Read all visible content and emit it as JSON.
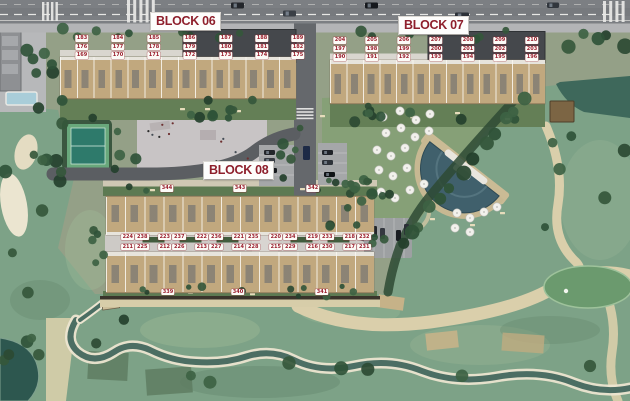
{
  "blocks": {
    "block06": {
      "title": "BLOCK 06",
      "rows": [
        [
          "183",
          "184",
          "185",
          "186",
          "187",
          "188",
          "189"
        ],
        [
          "176",
          "177",
          "178",
          "179",
          "180",
          "181",
          "182"
        ],
        [
          "169",
          "170",
          "171",
          "172",
          "173",
          "174",
          "175"
        ]
      ]
    },
    "block07": {
      "title": "BLOCK 07",
      "rows": [
        [
          "204",
          "205",
          "206",
          "207",
          "208",
          "209",
          "210"
        ],
        [
          "197",
          "198",
          "199",
          "200",
          "201",
          "202",
          "203"
        ],
        [
          "190",
          "191",
          "192",
          "193",
          "194",
          "195",
          "196"
        ]
      ]
    },
    "block08": {
      "title": "BLOCK 08",
      "pair_rows": [
        [
          [
            "224",
            "238"
          ],
          [
            "223",
            "237"
          ],
          [
            "222",
            "236"
          ],
          [
            "221",
            "235"
          ],
          [
            "220",
            "234"
          ],
          [
            "219",
            "233"
          ],
          [
            "218",
            "232"
          ]
        ],
        [
          [
            "211",
            "225"
          ],
          [
            "212",
            "226"
          ],
          [
            "213",
            "227"
          ],
          [
            "214",
            "228"
          ],
          [
            "215",
            "229"
          ],
          [
            "216",
            "230"
          ],
          [
            "217",
            "231"
          ]
        ]
      ],
      "outer_top": [
        "344",
        "343",
        "342"
      ],
      "outer_bottom": [
        "339",
        "340",
        "341"
      ]
    }
  },
  "colors": {
    "label_text": "#9b1f2e",
    "label_bg": "#fcfbf7",
    "title_text": "#8e1f2c",
    "golf_green": "#7da287",
    "house_tan": "#c1a87e",
    "road_gray": "#7c7f83",
    "pool_water": "#40606c"
  }
}
